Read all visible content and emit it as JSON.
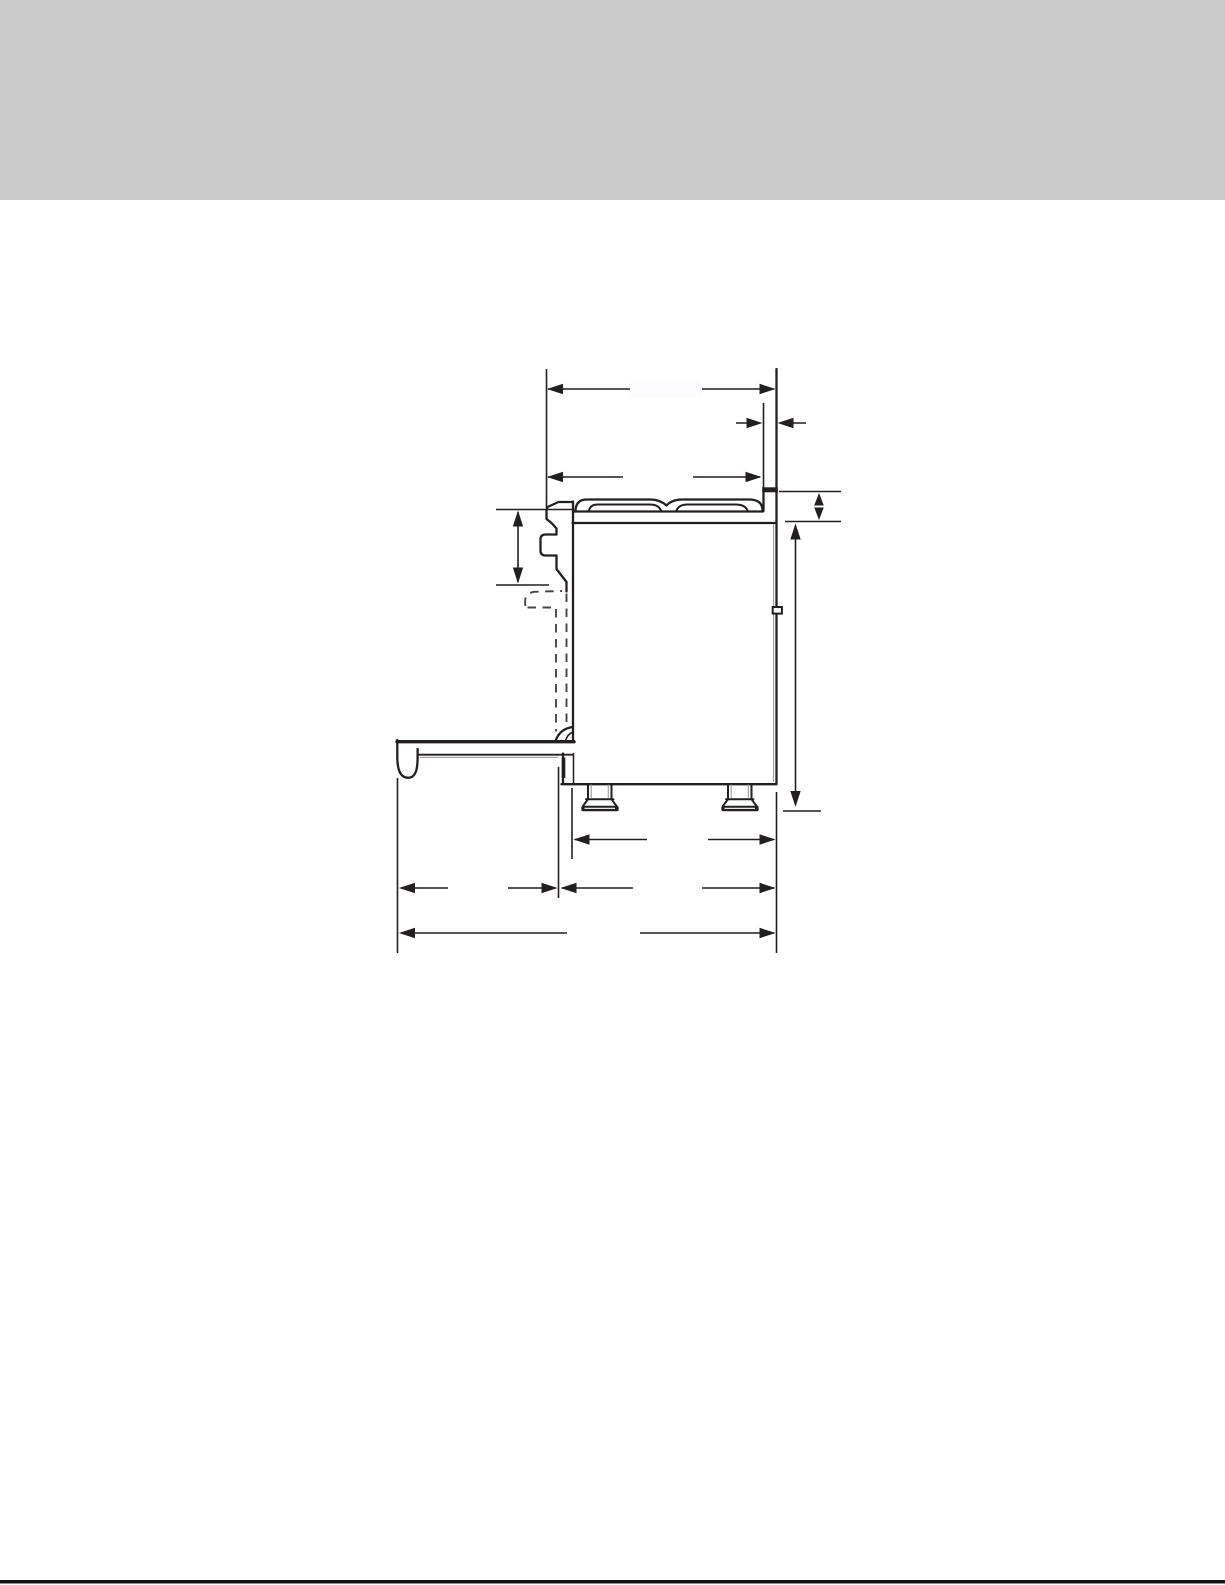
{
  "page": {
    "background": "#ffffff",
    "header_band_color": "#cbcbcb",
    "footer_rule_color": "#131313"
  },
  "figure": {
    "type": "dimension-drawing",
    "subject": "range-side-profile-with-open-oven-door",
    "line_color": "#231f20",
    "dash_color": "#454545",
    "shadow_color": "#9b9b9b",
    "blank_label_color": "#fdfdff",
    "labels_visible": false,
    "dimension_annotations": [
      {
        "id": "overall-top-depth-to-wall",
        "orientation": "horizontal",
        "label": ""
      },
      {
        "id": "rear-trim-thickness",
        "orientation": "horizontal",
        "label": ""
      },
      {
        "id": "cooktop-depth",
        "orientation": "horizontal",
        "label": ""
      },
      {
        "id": "control-panel-height",
        "orientation": "vertical",
        "label": ""
      },
      {
        "id": "rear-trim-height",
        "orientation": "vertical",
        "label": ""
      },
      {
        "id": "cooktop-height-from-floor",
        "orientation": "vertical",
        "label": ""
      },
      {
        "id": "base-depth",
        "orientation": "horizontal",
        "label": ""
      },
      {
        "id": "open-door-projection",
        "orientation": "horizontal",
        "label": ""
      },
      {
        "id": "lower-body-depth",
        "orientation": "horizontal",
        "label": ""
      },
      {
        "id": "overall-depth-door-open",
        "orientation": "horizontal",
        "label": ""
      }
    ]
  }
}
